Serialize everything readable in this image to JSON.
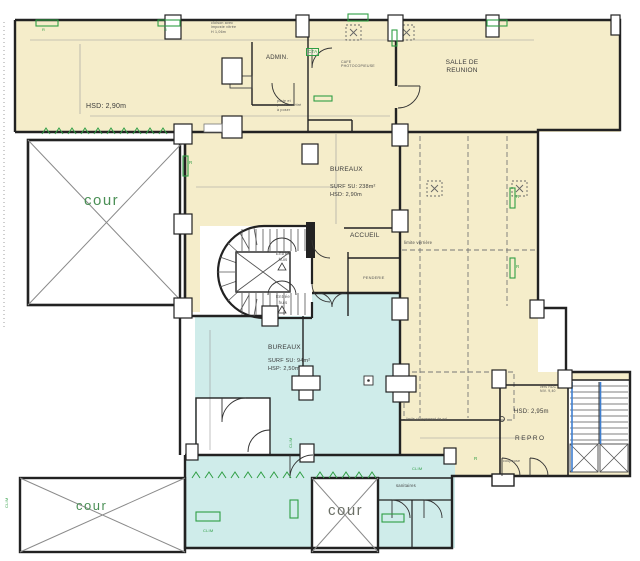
{
  "colors": {
    "room_beige": "#f5edca",
    "room_cyan": "#cfecea",
    "wall": "#222222",
    "annotation_green": "#2f9e44",
    "cour_green": "#4a8f55",
    "stair_blue": "#3f7fd0",
    "dimension_gray": "#999999"
  },
  "rooms": {
    "bureaux_top": {
      "hsd": "HSD: 2,90m"
    },
    "admin": {
      "name": "ADMIN."
    },
    "cafe": {
      "name": "CAFE\nPHOTOCOPIEUSE"
    },
    "salle_reunion": {
      "name": "SALLE DE\nREUNION"
    },
    "bureaux_mid": {
      "name": "BUREAUX",
      "surface": "SURF SU: 238m²",
      "hsd": "HSD: 2,90m"
    },
    "accueil": {
      "name": "ACCUEIL"
    },
    "penderie": {
      "name": "PENDERIE"
    },
    "bureaux_low": {
      "name": "BUREAUX",
      "surface": "SURF SU: 94m²",
      "hsp": "HSP: 2,50m"
    },
    "repro": {
      "name": "REPRO",
      "hsd": "HSD: 2,95m",
      "equip": "coupeuse"
    },
    "sanitaires": {
      "name": "sanitaires"
    },
    "cour": {
      "name": "cour"
    }
  },
  "annotations": {
    "cloison": "cloison avec\nimposte vitrée\nH 1,06m",
    "porte": "porte et\npanneau vitré\nà poser",
    "cta": "CTA",
    "limite_verriere": "limite verrière",
    "limite_sol": "limite changement de sol",
    "entree": "Entrée\nhuis",
    "vers_rdc": "vers RDC\nNIV. 9,40",
    "clim": "CLIM",
    "radiator": "R"
  }
}
